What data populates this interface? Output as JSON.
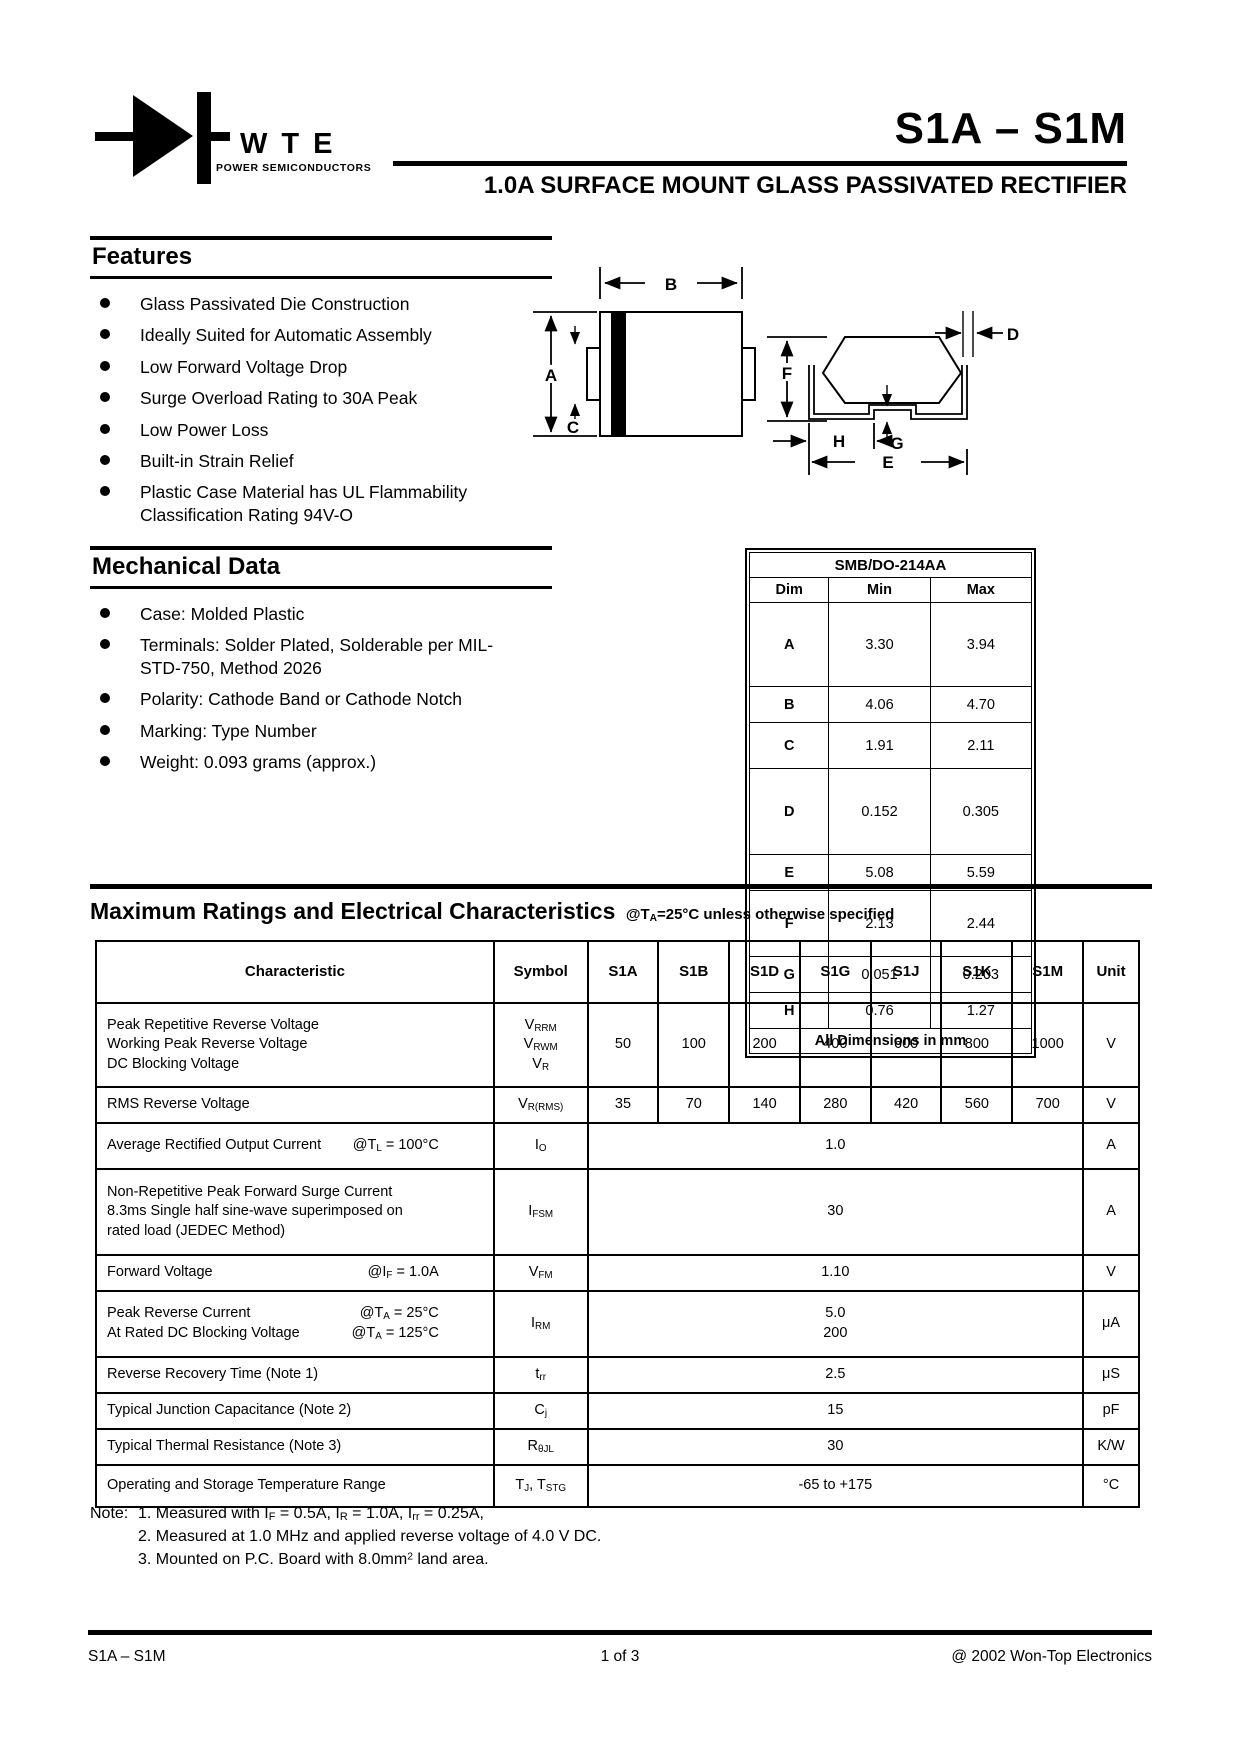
{
  "header": {
    "brand": "WTE",
    "brand_sub": "POWER SEMICONDUCTORS",
    "part_range": "S1A – S1M",
    "subtitle": "1.0A SURFACE MOUNT GLASS PASSIVATED RECTIFIER"
  },
  "features": {
    "title": "Features",
    "items": [
      "Glass Passivated Die Construction",
      "Ideally Suited for Automatic Assembly",
      "Low Forward Voltage Drop",
      "Surge Overload Rating to 30A Peak",
      "Low Power Loss",
      "Built-in Strain Relief",
      "Plastic Case Material has UL Flammability Classification Rating 94V-O"
    ]
  },
  "mechanical": {
    "title": "Mechanical Data",
    "items": [
      "Case: Molded Plastic",
      "Terminals: Solder Plated, Solderable per MIL-STD-750, Method 2026",
      "Polarity: Cathode Band or Cathode Notch",
      "Marking: Type Number",
      "Weight: 0.093 grams (approx.)"
    ]
  },
  "diagram": {
    "labels": {
      "a": "A",
      "b": "B",
      "c": "C",
      "d": "D",
      "e": "E",
      "f": "F",
      "g": "G",
      "h": "H"
    }
  },
  "dim_table": {
    "title": "SMB/DO-214AA",
    "headers": [
      "Dim",
      "Min",
      "Max"
    ],
    "rows": [
      [
        "A",
        "3.30",
        "3.94"
      ],
      [
        "B",
        "4.06",
        "4.70"
      ],
      [
        "C",
        "1.91",
        "2.11"
      ],
      [
        "D",
        "0.152",
        "0.305"
      ],
      [
        "E",
        "5.08",
        "5.59"
      ],
      [
        "F",
        "2.13",
        "2.44"
      ],
      [
        "G",
        "0.051",
        "0.203"
      ],
      [
        "H",
        "0.76",
        "1.27"
      ]
    ],
    "footer": "All Dimensions in mm"
  },
  "ratings": {
    "title": "Maximum Ratings and Electrical Characteristics",
    "title_note": [
      {
        "t": "@T"
      },
      {
        "s": "A"
      },
      {
        "t": "=25°C unless otherwise specified"
      }
    ],
    "headers": [
      "Characteristic",
      "Symbol",
      "S1A",
      "S1B",
      "S1D",
      "S1G",
      "S1J",
      "S1K",
      "S1M",
      "Unit"
    ],
    "rows": [
      {
        "characteristic": [
          {
            "left": [
              {
                "t": "Peak Repetitive Reverse Voltage"
              }
            ]
          },
          {
            "left": [
              {
                "t": "Working Peak Reverse Voltage"
              }
            ]
          },
          {
            "left": [
              {
                "t": "DC Blocking Voltage"
              }
            ]
          }
        ],
        "symbol": [
          [
            {
              "t": "V"
            },
            {
              "s": "RRM"
            }
          ],
          [
            {
              "t": "V"
            },
            {
              "s": "RWM"
            }
          ],
          [
            {
              "t": "V"
            },
            {
              "s": "R"
            }
          ]
        ],
        "values": [
          "50",
          "100",
          "200",
          "400",
          "600",
          "800",
          "1000"
        ],
        "unit": "V"
      },
      {
        "characteristic": [
          {
            "left": [
              {
                "t": "RMS Reverse Voltage"
              }
            ]
          }
        ],
        "symbol": [
          [
            {
              "t": "V"
            },
            {
              "s": "R(RMS)"
            }
          ]
        ],
        "values": [
          "35",
          "70",
          "140",
          "280",
          "420",
          "560",
          "700"
        ],
        "unit": "V"
      },
      {
        "characteristic": [
          {
            "left": [
              {
                "t": "Average Rectified Output Current"
              }
            ],
            "right": [
              {
                "t": "@T"
              },
              {
                "s": "L"
              },
              {
                "t": " = 100°C"
              }
            ]
          }
        ],
        "symbol": [
          [
            {
              "t": "I"
            },
            {
              "s": "O"
            }
          ]
        ],
        "span": "1.0",
        "unit": "A"
      },
      {
        "characteristic": [
          {
            "left": [
              {
                "t": "Non-Repetitive Peak Forward Surge Current"
              }
            ]
          },
          {
            "left": [
              {
                "t": "8.3ms Single half sine-wave superimposed on"
              }
            ]
          },
          {
            "left": [
              {
                "t": "rated load (JEDEC Method)"
              }
            ]
          }
        ],
        "symbol": [
          [
            {
              "t": "I"
            },
            {
              "s": "FSM"
            }
          ]
        ],
        "span": "30",
        "unit": "A"
      },
      {
        "characteristic": [
          {
            "left": [
              {
                "t": "Forward Voltage"
              }
            ],
            "right": [
              {
                "t": "@I"
              },
              {
                "s": "F"
              },
              {
                "t": " = 1.0A"
              }
            ]
          }
        ],
        "symbol": [
          [
            {
              "t": "V"
            },
            {
              "s": "FM"
            }
          ]
        ],
        "span": "1.10",
        "unit": "V"
      },
      {
        "characteristic": [
          {
            "left": [
              {
                "t": "Peak Reverse Current"
              }
            ],
            "right": [
              {
                "t": "@T"
              },
              {
                "s": "A"
              },
              {
                "t": " = 25°C"
              }
            ]
          },
          {
            "left": [
              {
                "t": "At Rated DC Blocking Voltage"
              }
            ],
            "right": [
              {
                "t": "@T"
              },
              {
                "s": "A"
              },
              {
                "t": " = 125°C"
              }
            ]
          }
        ],
        "symbol": [
          [
            {
              "t": "I"
            },
            {
              "s": "RM"
            }
          ]
        ],
        "span_lines": [
          "5.0",
          "200"
        ],
        "unit": "μA"
      },
      {
        "characteristic": [
          {
            "left": [
              {
                "t": "Reverse Recovery Time (Note 1)"
              }
            ]
          }
        ],
        "symbol": [
          [
            {
              "t": "t"
            },
            {
              "s": "rr"
            }
          ]
        ],
        "span": "2.5",
        "unit": "μS"
      },
      {
        "characteristic": [
          {
            "left": [
              {
                "t": "Typical Junction Capacitance (Note 2)"
              }
            ]
          }
        ],
        "symbol": [
          [
            {
              "t": "C"
            },
            {
              "s": "j"
            }
          ]
        ],
        "span": "15",
        "unit": "pF"
      },
      {
        "characteristic": [
          {
            "left": [
              {
                "t": "Typical Thermal Resistance (Note 3)"
              }
            ]
          }
        ],
        "symbol": [
          [
            {
              "t": "R"
            },
            {
              "s": "θJL"
            }
          ]
        ],
        "span": "30",
        "unit": "K/W"
      },
      {
        "characteristic": [
          {
            "left": [
              {
                "t": "Operating and Storage Temperature Range"
              }
            ]
          }
        ],
        "symbol": [
          [
            {
              "t": "T"
            },
            {
              "s": "J"
            },
            {
              "t": ", T"
            },
            {
              "s": "STG"
            }
          ]
        ],
        "span": "-65 to +175",
        "unit": "°C"
      }
    ]
  },
  "notes": {
    "label": "Note:",
    "lines": [
      [
        {
          "t": "1. Measured with I"
        },
        {
          "s": "F"
        },
        {
          "t": " = 0.5A, I"
        },
        {
          "s": "R"
        },
        {
          "t": " = 1.0A, I"
        },
        {
          "s": "rr"
        },
        {
          "t": " = 0.25A,"
        }
      ],
      [
        {
          "t": "2. Measured at 1.0 MHz and applied reverse voltage of 4.0 V DC."
        }
      ],
      [
        {
          "t": "3. Mounted on P.C. Board with 8.0mm"
        },
        {
          "p": "2"
        },
        {
          "t": " land area."
        }
      ]
    ]
  },
  "footer": {
    "left": "S1A – S1M",
    "center": "1 of 3",
    "right": "@ 2002 Won-Top Electronics"
  }
}
